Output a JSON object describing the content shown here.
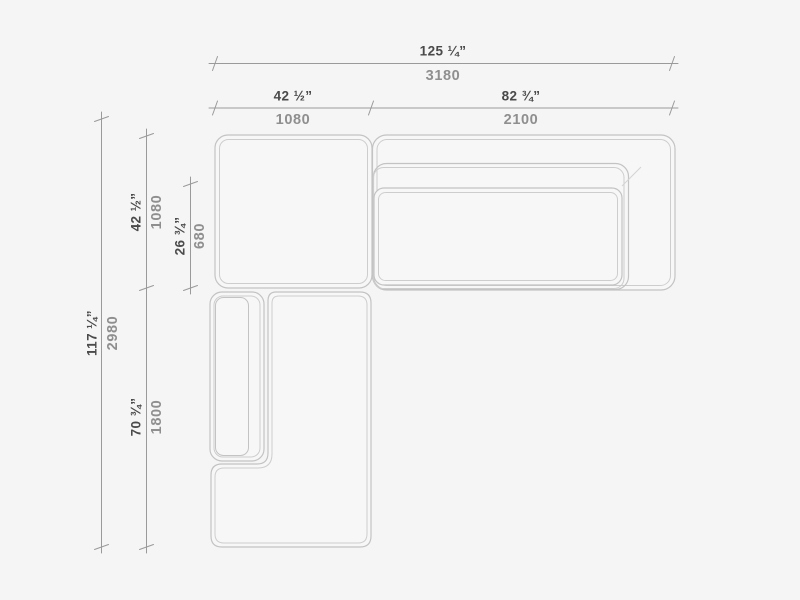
{
  "drawing": {
    "title": "sofa-sectional-top-view-dimension-diagram",
    "colors": {
      "background": "#f5f5f5",
      "furniture_line": "#c3c3c3",
      "furniture_inner_line": "#cdcdcd",
      "furniture_fill": "#f7f7f7",
      "dimension_line": "#9a9a9a",
      "imperial_text": "#4a4a4a",
      "metric_text": "#8f8f8f"
    }
  },
  "dims": {
    "overall_width": {
      "imperial": "125 ¼”",
      "metric": "3180"
    },
    "left_module_width": {
      "imperial": "42 ½”",
      "metric": "1080"
    },
    "right_module_width": {
      "imperial": "82 ¾”",
      "metric": "2100"
    },
    "overall_depth": {
      "imperial": "117 ¼”",
      "metric": "2980"
    },
    "upper_module_depth": {
      "imperial": "42 ½”",
      "metric": "1080"
    },
    "seat_depth": {
      "imperial": "26 ¾”",
      "metric": "680"
    },
    "chaise_length": {
      "imperial": "70 ¾”",
      "metric": "1800"
    }
  }
}
